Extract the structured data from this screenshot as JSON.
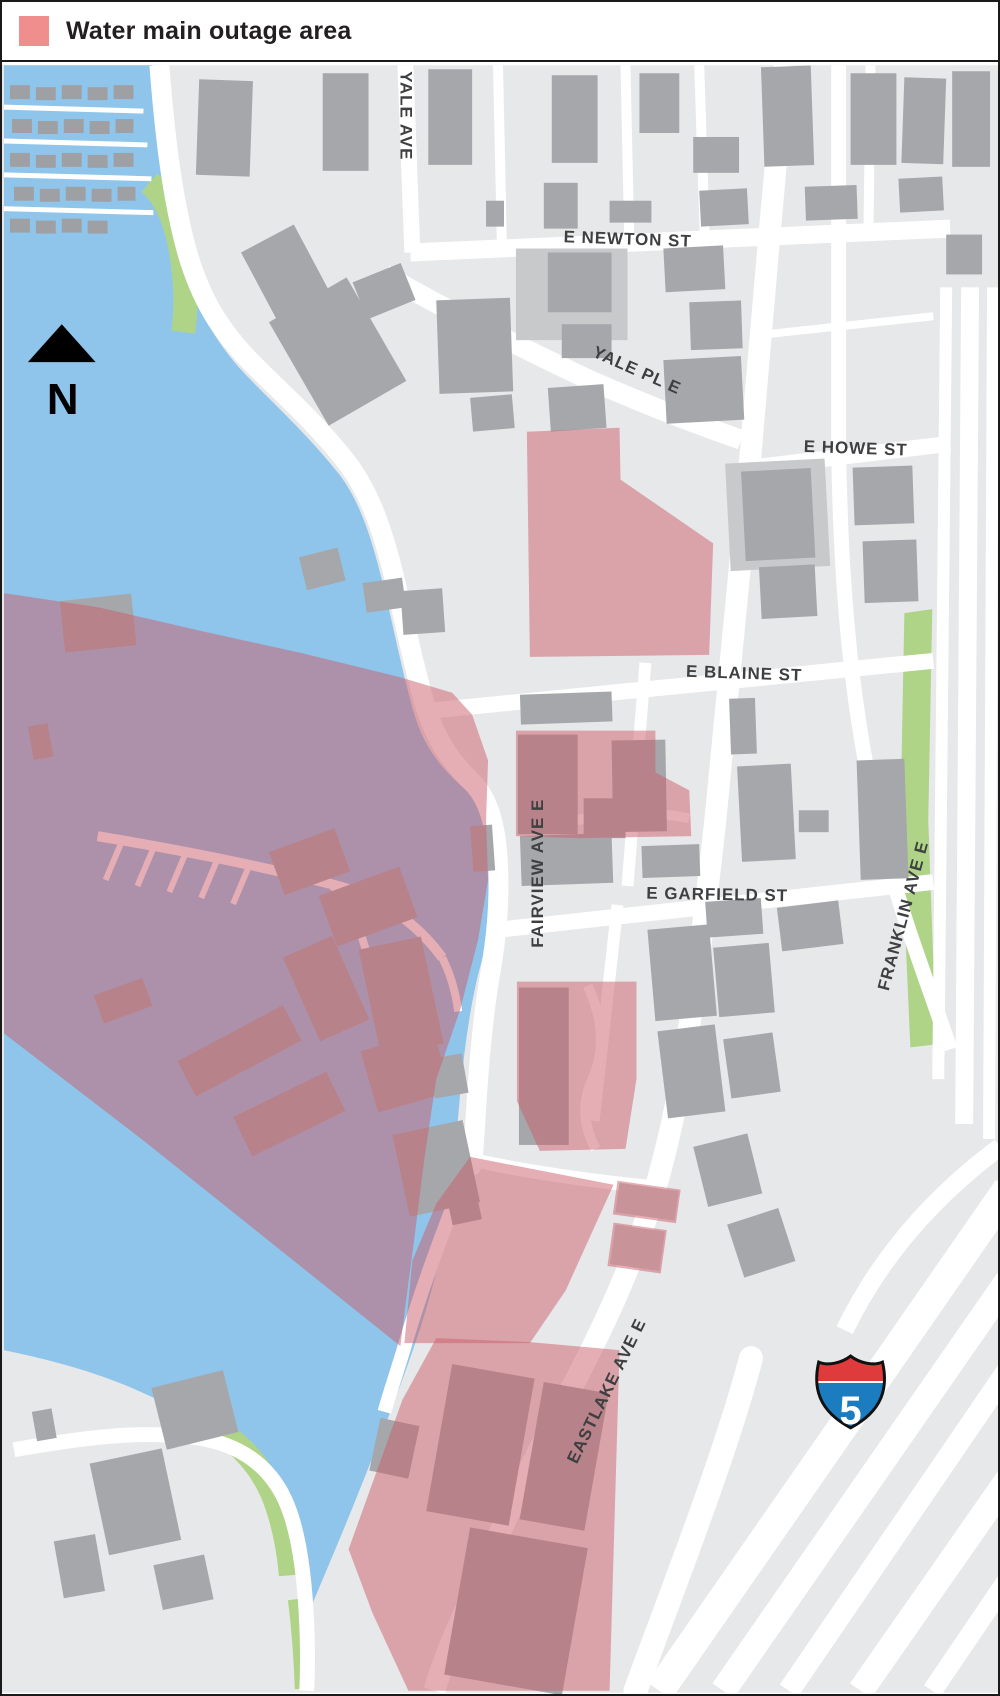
{
  "legend": {
    "title": "Water main outage area",
    "swatch_color": "#F08E8E"
  },
  "compass": {
    "north_label": "N"
  },
  "highway_shield": {
    "route_number": "5"
  },
  "streets": {
    "yale_ave": "YALE AVE",
    "e_newton_st": "E NEWTON ST",
    "yale_pl_e": "YALE PL E",
    "e_howe_st": "E HOWE ST",
    "e_blaine_st": "E BLAINE ST",
    "e_garfield_st": "E GARFIELD ST",
    "fairview_ave_e": "FAIRVIEW AVE E",
    "franklin_ave_e": "FRANKLIN AVE E",
    "eastlake_ave_e": "EASTLAKE AVE E"
  },
  "colors": {
    "water": "#8FC5EA",
    "land": "#E7E8E9",
    "road": "#FFFFFF",
    "building": "#A5A7AA",
    "building_light": "#C7C9CB",
    "houseboat": "#9EA0A3",
    "green": "#AFD487",
    "outage_overlay": "rgba(203,94,106,0.5)",
    "label_text": "#3E3F41",
    "shield_red": "#DF3A3C",
    "shield_blue": "#1B7CC0",
    "north_arrow": "#000000"
  }
}
